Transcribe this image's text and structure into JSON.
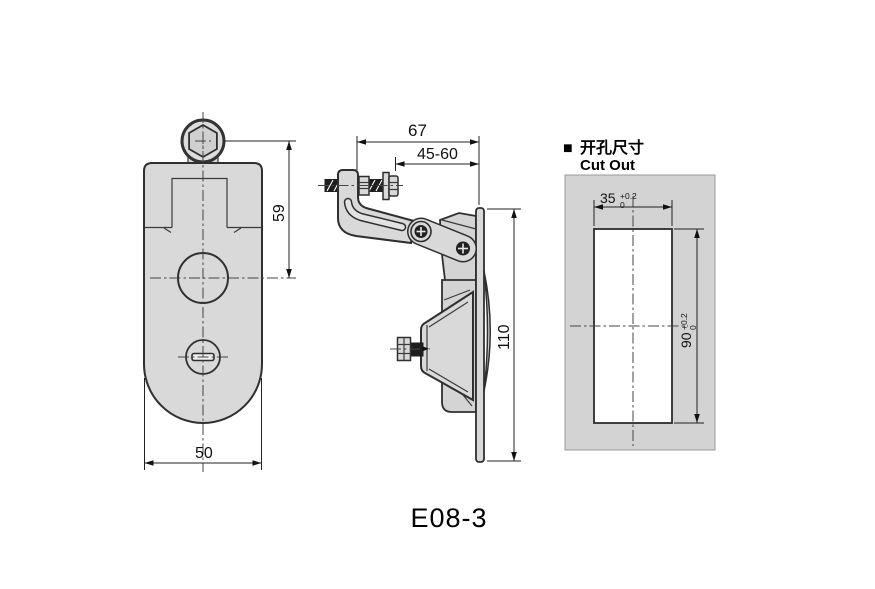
{
  "title": "E08-3",
  "colors": {
    "background": "#ffffff",
    "part_fill": "#d9d9d9",
    "panel_fill": "#d3d3d3",
    "cutout_fill": "#ffffff",
    "line": "#2f2f2f",
    "rod_fill": "#1e1e1e"
  },
  "views": {
    "front": {
      "dim_height": "59",
      "dim_width": "50"
    },
    "side": {
      "dim_total_depth": "67",
      "dim_grip_range": "45-60",
      "dim_height": "110"
    },
    "cutout": {
      "section_marker": "■",
      "label_cn": "开孔尺寸",
      "label_en": "Cut Out",
      "width": {
        "value": "35",
        "tol_plus": "+0.2",
        "tol_minus": "0"
      },
      "height": {
        "value": "90",
        "tol_plus": "+0.2",
        "tol_minus": "0"
      }
    }
  }
}
